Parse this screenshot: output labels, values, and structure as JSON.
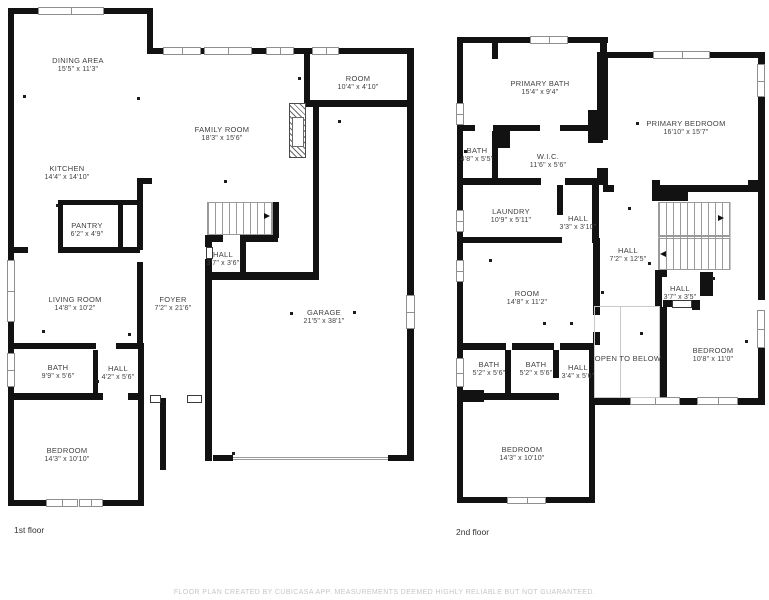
{
  "colors": {
    "wall": "#121212",
    "label_text": "#3f3f3f",
    "floor_tag_text": "#333333",
    "footer_text": "#c6c6c6",
    "window_line": "#8f8f8f"
  },
  "footer": {
    "disclaimer": "FLOOR PLAN CREATED BY CUBICASA APP. MEASUREMENTS DEEMED HIGHLY RELIABLE BUT NOT GUARANTEED."
  },
  "floors": [
    {
      "label": "1st floor",
      "rooms": [
        {
          "name": "DINING AREA",
          "dims": "15'5\" x 11'3\""
        },
        {
          "name": "KITCHEN",
          "dims": "14'4\" x 14'10\""
        },
        {
          "name": "PANTRY",
          "dims": "6'2\" x 4'9\""
        },
        {
          "name": "FAMILY ROOM",
          "dims": "18'3\" x 15'6\""
        },
        {
          "name": "ROOM",
          "dims": "10'4\" x 4'10\""
        },
        {
          "name": "LIVING ROOM",
          "dims": "14'8\" x 10'2\""
        },
        {
          "name": "FOYER",
          "dims": "7'2\" x 21'6\""
        },
        {
          "name": "HALL",
          "dims": "3'7\" x 3'6\""
        },
        {
          "name": "GARAGE",
          "dims": "21'5\" x 38'1\""
        },
        {
          "name": "BATH",
          "dims": "9'9\" x 5'6\""
        },
        {
          "name": "HALL",
          "dims": "4'2\" x 5'6\""
        },
        {
          "name": "BEDROOM",
          "dims": "14'3\" x 10'10\""
        }
      ]
    },
    {
      "label": "2nd floor",
      "rooms": [
        {
          "name": "PRIMARY BATH",
          "dims": "15'4\" x 9'4\""
        },
        {
          "name": "PRIMARY BEDROOM",
          "dims": "16'10\" x 15'7\""
        },
        {
          "name": "BATH",
          "dims": "4'8\" x 5'5\""
        },
        {
          "name": "W.I.C.",
          "dims": "11'6\" x 5'6\""
        },
        {
          "name": "LAUNDRY",
          "dims": "10'9\" x 5'11\""
        },
        {
          "name": "HALL",
          "dims": "3'3\" x 3'10\""
        },
        {
          "name": "HALL",
          "dims": "7'2\" x 12'5\""
        },
        {
          "name": "ROOM",
          "dims": "14'8\" x 11'2\""
        },
        {
          "name": "HALL",
          "dims": "3'7\" x 3'5\""
        },
        {
          "name": "OPEN TO BELOW",
          "dims": ""
        },
        {
          "name": "BEDROOM",
          "dims": "10'8\" x 11'0\""
        },
        {
          "name": "BATH",
          "dims": "5'2\" x 5'6\""
        },
        {
          "name": "BATH",
          "dims": "5'2\" x 5'6\""
        },
        {
          "name": "HALL",
          "dims": "3'4\" x 5'6\""
        },
        {
          "name": "BEDROOM",
          "dims": "14'3\" x 10'10\""
        }
      ]
    }
  ]
}
